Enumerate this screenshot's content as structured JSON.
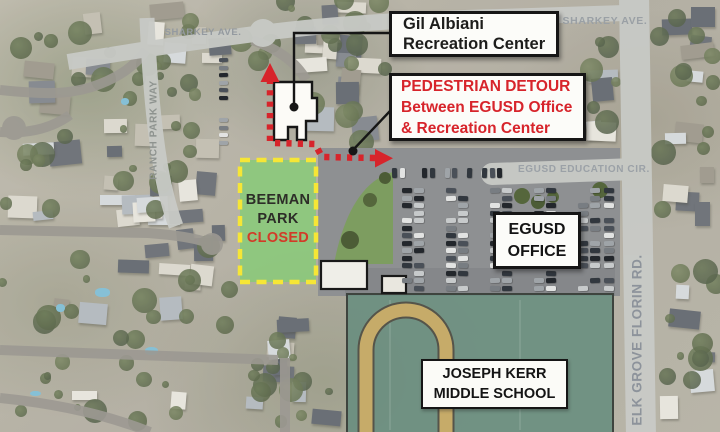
{
  "title": "Pedestrian detour map",
  "map": {
    "street_labels": [
      {
        "name": "sharkey-ave-left",
        "text": "SHARKEY AVE."
      },
      {
        "name": "sharkey-ave-right",
        "text": "SHARKEY AVE."
      },
      {
        "name": "ranch-park-way",
        "text": "RANCH PARK WAY"
      },
      {
        "name": "egusd-education-cir",
        "text": "EGUSD EDUCATION CIR."
      },
      {
        "name": "elk-grove-florin-rd",
        "text": "ELK GROVE FLORIN RD."
      }
    ],
    "callouts": {
      "recreation_center": {
        "line1": "Gil Albiani",
        "line2": "Recreation Center"
      },
      "pedestrian_detour": {
        "line1": "PEDESTRIAN DETOUR",
        "line2": "Between EGUSD Office",
        "line3": "& Recreation Center"
      },
      "egusd_office": {
        "line1": "EGUSD",
        "line2": "OFFICE"
      },
      "joseph_kerr": {
        "line1": "JOSEPH KERR",
        "line2": "MIDDLE SCHOOL"
      }
    },
    "beeman_park": {
      "line1": "BEEMAN",
      "line2": "PARK",
      "status": "CLOSED"
    },
    "colors": {
      "detour_red": "#d7242b",
      "beeman_green": "#8cc87c",
      "beeman_border_yellow": "#f6e636",
      "closed_red": "#d23b28",
      "school_teal": "#6d9283",
      "track_tan": "#c6ab69",
      "road_highlight": "#c8cac6",
      "street_label_gray": "#949aa0",
      "callout_border_black": "#161616"
    }
  }
}
